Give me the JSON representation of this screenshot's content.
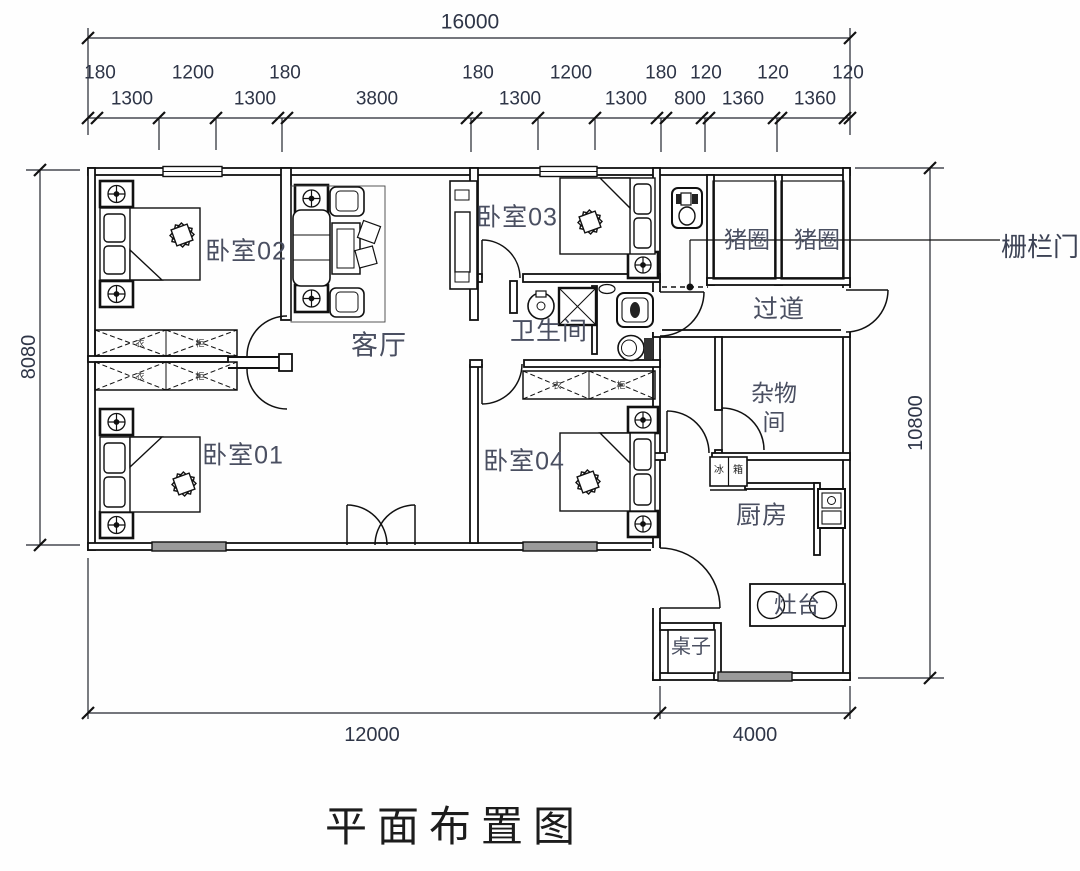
{
  "title": "平面布置图",
  "dimensions": {
    "top_total": "16000",
    "top_upper": [
      "180",
      "1200",
      "180",
      "180",
      "1200",
      "180",
      "120",
      "120",
      "120"
    ],
    "top_lower": [
      "1300",
      "1300",
      "3800",
      "1300",
      "1300",
      "800",
      "1360",
      "1360"
    ],
    "left_height": "8080",
    "right_height": "10800",
    "bottom_left": "12000",
    "bottom_right": "4000"
  },
  "rooms": {
    "bedroom2": "卧室02",
    "bedroom3": "卧室03",
    "bedroom1": "卧室01",
    "bedroom4": "卧室04",
    "living": "客厅",
    "bathroom": "卫生间",
    "pigpen1": "猪圈",
    "pigpen2": "猪圈",
    "corridor": "过道",
    "storage_line1": "杂物",
    "storage_line2": "间",
    "kitchen": "厨房"
  },
  "fixtures": {
    "stove": "灶台",
    "table": "桌子",
    "fridge_char1": "冰",
    "fridge_char2": "箱",
    "wardrobe_char1": "衣",
    "wardrobe_char2": "柜"
  },
  "annotations": {
    "fence_gate": "栅栏门"
  }
}
